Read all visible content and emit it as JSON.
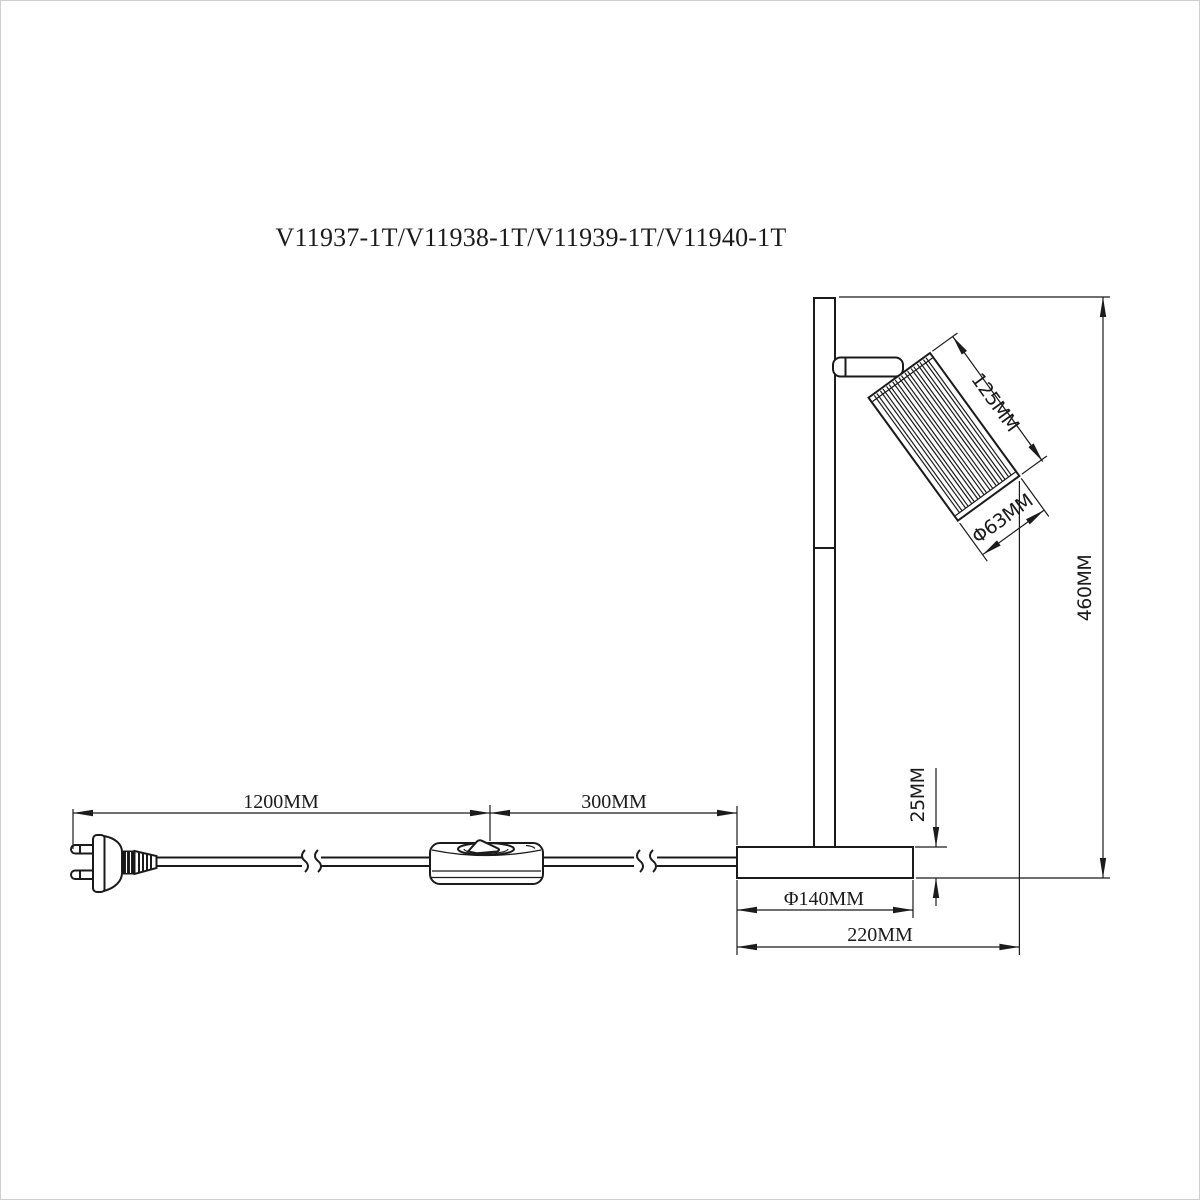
{
  "title": "V11937-1T/V11938-1T/V11939-1T/V11940-1T",
  "dimensions": {
    "head_length": "125MM",
    "head_diameter": "Φ63MM",
    "total_height": "460MM",
    "base_thickness": "25MM",
    "base_diameter": "Φ140MM",
    "total_depth": "220MM",
    "cord_plug_to_switch": "1200MM",
    "cord_switch_to_base": "300MM"
  },
  "colors": {
    "line": "#1b1b1b",
    "background": "#ffffff",
    "border": "#cfcfcf"
  }
}
